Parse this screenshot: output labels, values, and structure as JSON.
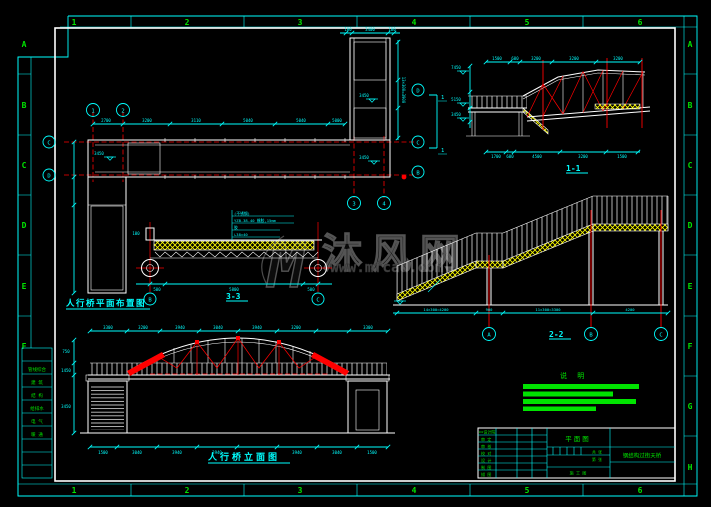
{
  "frame": {
    "cols": [
      "1",
      "2",
      "3",
      "4",
      "5",
      "6"
    ],
    "rows_right": [
      "A",
      "B",
      "C",
      "D",
      "E",
      "F",
      "G",
      "H"
    ],
    "rows_left": [
      "A",
      "B",
      "C",
      "D",
      "E",
      "F"
    ]
  },
  "sign_table": {
    "rows": [
      "管线综合",
      "建 筑",
      "结 构",
      "给排水",
      "电 气",
      "暖 通"
    ]
  },
  "watermark": {
    "logo": "M",
    "name": "沐风网",
    "url": "www.mfcad.com"
  },
  "plan": {
    "caption": "人行桥平面布置图",
    "bubbles": {
      "c1": "1",
      "c2": "2",
      "c3": "3",
      "c4": "4",
      "rl_c": "C",
      "rl_d": "D",
      "rr_d": "D",
      "rr_c": "C",
      "rr_b": "B"
    },
    "section_mark": "1",
    "level_deck": "3450",
    "level_landing": "3450",
    "level_mid": "3450",
    "dims_top": [
      "2700",
      "3200",
      "3110",
      "5040",
      "5040",
      "5000"
    ],
    "dims_tower": [
      "100",
      "3400",
      "100"
    ],
    "dim_side": "13×300=3900"
  },
  "section33": {
    "label": "3-3",
    "bubble_left": "B",
    "bubble_right": "C",
    "leaders": [
      "(不锈钢)",
      "YZB-38-40 橡胶,15mm",
      "胶",
      "∟38×40"
    ],
    "dims": [
      "500",
      "5800",
      "500"
    ],
    "dim_small_left": "100"
  },
  "section11": {
    "label": "1-1",
    "levels": [
      "7450",
      "5150",
      "3450"
    ],
    "dims_top": [
      "1500",
      "600",
      "3200",
      "3200",
      "3200"
    ],
    "dims_bottom": [
      "1700",
      "600",
      "4500",
      "3200",
      "1500"
    ]
  },
  "section22": {
    "label": "2-2",
    "bubbles": [
      "A",
      "B",
      "C"
    ],
    "dims": [
      "14×300=4200",
      "900",
      "11×300=3300",
      "4200"
    ]
  },
  "elevation": {
    "caption": "人行桥立面图",
    "dims_top": [
      "3300",
      "3200",
      "3940",
      "3040",
      "3940",
      "3200",
      "3300"
    ],
    "dims_bottom": [
      "1500",
      "3040",
      "3940",
      "3940",
      "3940",
      "3040",
      "1500"
    ],
    "dims_left": [
      "750",
      "1450",
      "3450"
    ]
  },
  "notes": {
    "title": "说 明",
    "bars": [
      "116",
      "90",
      "113",
      "73"
    ]
  },
  "titleblock": {
    "drawing_title": "平面图",
    "project": "钢结构过街天桥",
    "left_header": "××设计院",
    "left_rows": [
      "审 定",
      "审 核",
      "校 对",
      "设 计",
      "制 图",
      "描 图"
    ],
    "mid_items": [
      "共 张",
      "第 张",
      "施 工 图"
    ]
  }
}
